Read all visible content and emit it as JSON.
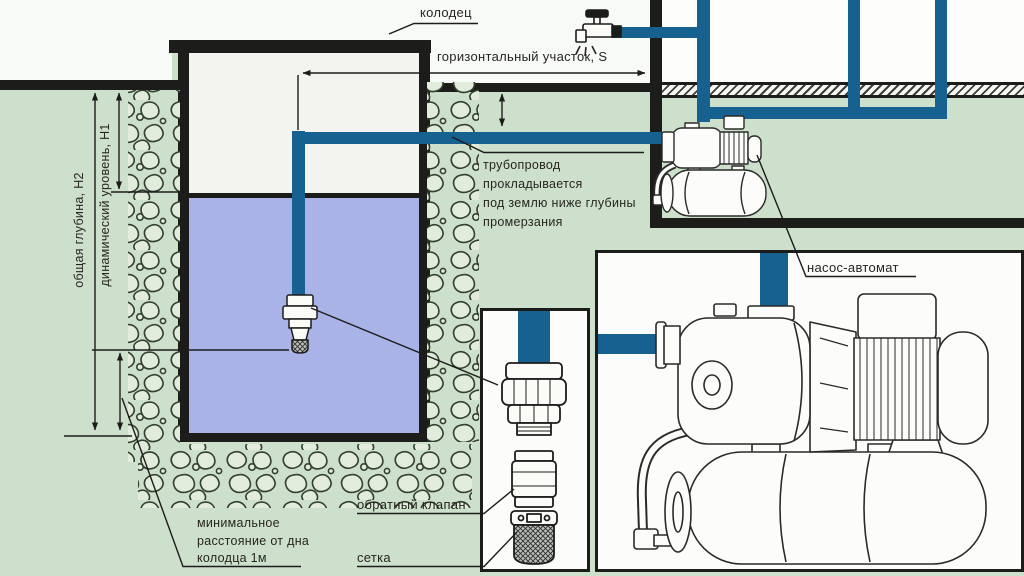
{
  "labels": {
    "well": "колодец",
    "horizontal_section": "горизонтальный участок, S",
    "pipeline_note": {
      "line1": "трубопровод",
      "line2": "прокладывается",
      "line3": "под землю ниже глубины",
      "line4": "промерзания"
    },
    "pump_station": "насос-автомат",
    "check_valve": "обратный клапан",
    "strainer": "сетка",
    "min_distance": {
      "line1": "минимальное",
      "line2": "расстояние от дна",
      "line3": "колодца 1м"
    },
    "total_depth": "общая глубина, H2",
    "dynamic_level": "динамический уровень, H1"
  },
  "icons": {
    "faucet": "outdoor-tap-with-spray-icon"
  },
  "colors": {
    "pipe_blue": "#16618f",
    "water_blue": "#a9b3e8",
    "soil_green": "#cde0cc",
    "structure_black": "#1c1c1a",
    "well_interior": "#f3f3ef"
  }
}
